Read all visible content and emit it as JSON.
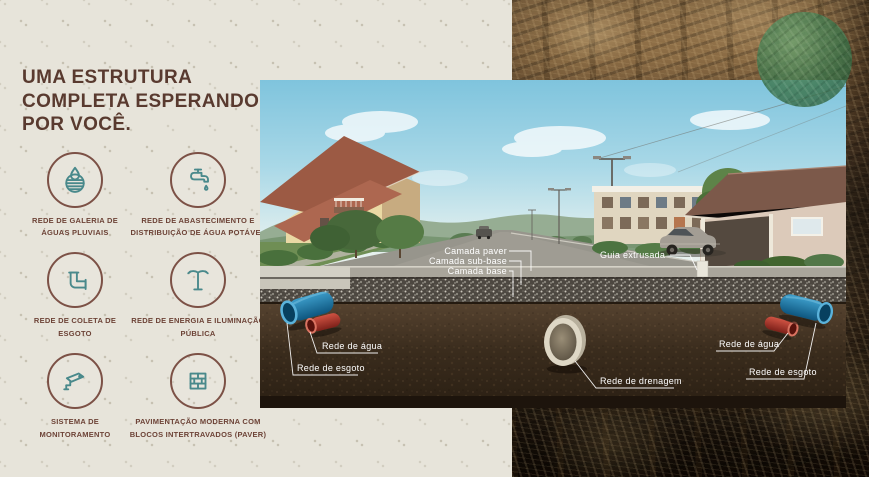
{
  "header": {
    "title_lines": [
      "UMA ESTRUTURA",
      "COMPLETA ESPERANDO",
      "POR VOCÊ."
    ]
  },
  "features": [
    {
      "icon": "storm-drain-icon",
      "label": "REDE DE GALERIA DE ÁGUAS PLUVIAIS"
    },
    {
      "icon": "faucet-icon",
      "label": "REDE DE ABASTECIMENTO E DISTRIBUIÇÃO DE ÁGUA POTÁVEL"
    },
    {
      "icon": "sewer-pipe-icon",
      "label": "REDE DE COLETA DE ESGOTO"
    },
    {
      "icon": "street-light-icon",
      "label": "REDE DE ENERGIA E ILUMINAÇÃO PÚBLICA"
    },
    {
      "icon": "cctv-camera-icon",
      "label": "SISTEMA DE MONITORAMENTO"
    },
    {
      "icon": "paver-bricks-icon",
      "label": "PAVIMENTAÇÃO MODERNA COM BLOCOS INTERTRAVADOS (PAVER)"
    }
  ],
  "diagram": {
    "layers": {
      "paver": "Camada paver",
      "sub_base": "Camada sub-base",
      "base": "Camada base",
      "curb": "Guia extrusada"
    },
    "utilities": {
      "water_left": "Rede de água",
      "sewage_left": "Rede de esgoto",
      "drainage": "Rede de drenagem",
      "water_right": "Rede de água",
      "sewage_right": "Rede de esgoto"
    }
  },
  "colors": {
    "accent_maroon": "#593a2f",
    "icon_teal": "#49898b",
    "panel_beige": "#e7e4da",
    "pipe_water_red": "#bb3a2c",
    "pipe_sewage_blue": "#1d7db2",
    "logo_green": "#3f7a50"
  }
}
